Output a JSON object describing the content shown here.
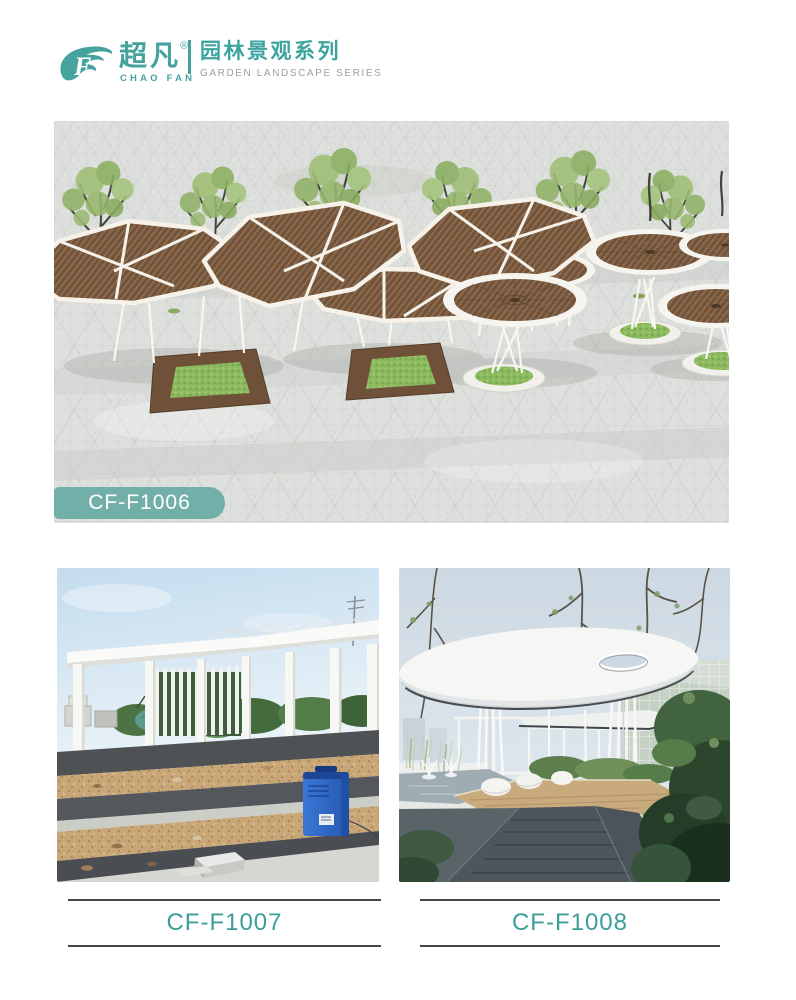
{
  "page": {
    "background": "#ffffff",
    "accent_teal": "#45a29c",
    "caption_text_color": "#3b9e99",
    "caption_line_color": "#43464a",
    "badge_background": "rgba(104,170,164,0.92)"
  },
  "header": {
    "logo": {
      "cn": "超凡",
      "reg": "®",
      "en": "CHAO FAN"
    },
    "series": {
      "cn": "园林景观系列",
      "en": "GARDEN LANDSCAPE SERIES"
    }
  },
  "figures": [
    {
      "code": "CF-F1006"
    },
    {
      "code": "CF-F1007"
    },
    {
      "code": "CF-F1008"
    }
  ]
}
